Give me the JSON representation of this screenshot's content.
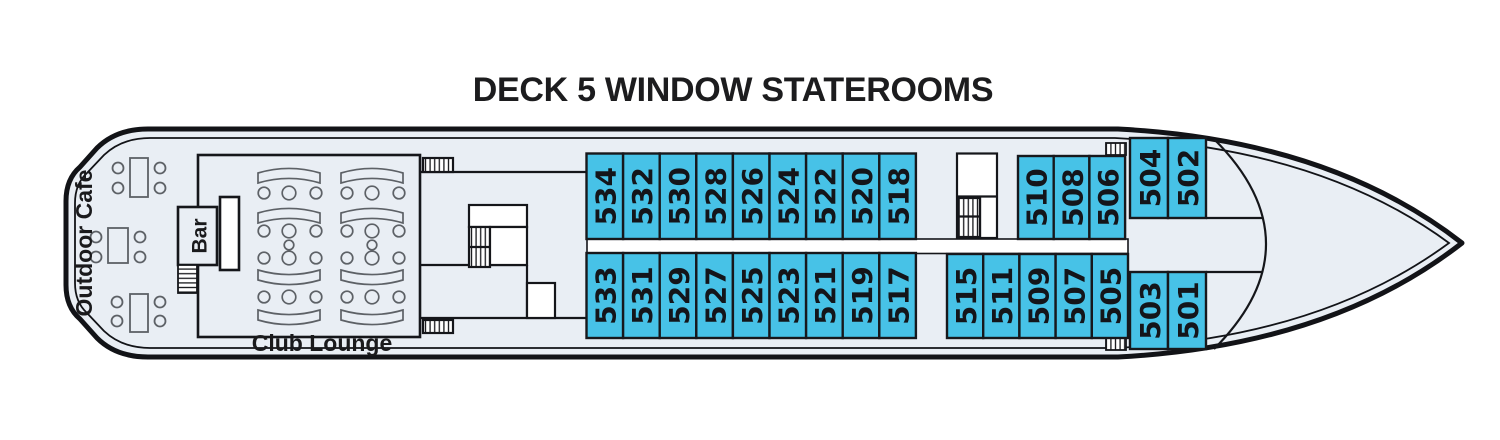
{
  "title": "DECK 5 WINDOW STATEROOMS",
  "labels": {
    "outdoor_cafe": "Outdoor Cafe",
    "bar": "Bar",
    "club_lounge": "Club Lounge"
  },
  "colors": {
    "stateroom_fill": "#47C2E7",
    "deck_fill": "#E9EEF4",
    "corridor": "#FFFFFF",
    "outline": "#17181C"
  },
  "staterooms": {
    "top_main": [
      "534",
      "532",
      "530",
      "528",
      "526",
      "524",
      "522",
      "520",
      "518"
    ],
    "top_forward": [
      "510",
      "508",
      "506"
    ],
    "top_bow": [
      "504",
      "502"
    ],
    "bottom_main": [
      "533",
      "531",
      "529",
      "527",
      "525",
      "523",
      "521",
      "519",
      "517"
    ],
    "bottom_forward": [
      "515",
      "511",
      "509",
      "507",
      "505"
    ],
    "bottom_bow": [
      "503",
      "501"
    ]
  }
}
